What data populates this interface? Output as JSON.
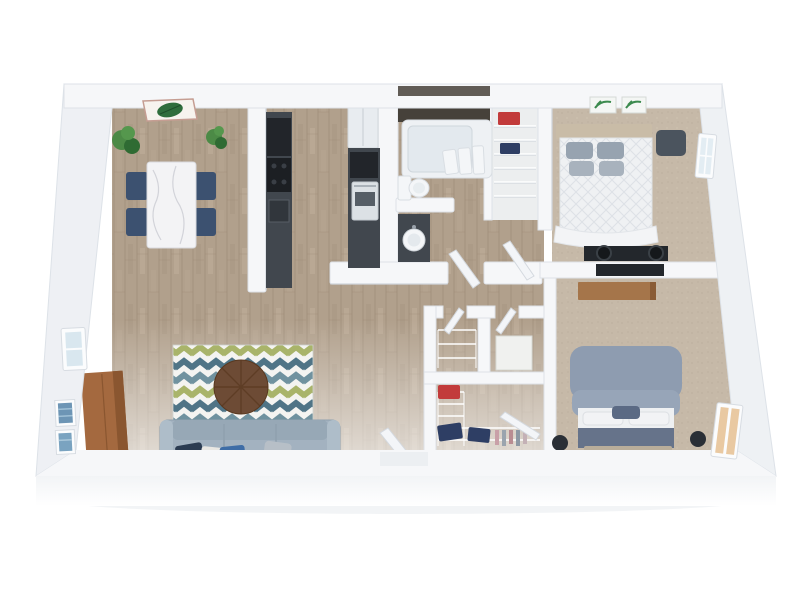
{
  "scene": {
    "type": "3d-rendered-floorplan",
    "camera": "top-down isometric, two-bedroom apartment",
    "rooms": [
      {
        "name": "dining-area",
        "floor": "wood",
        "furniture": [
          "marble-dining-table",
          "navy-dining-chair x4",
          "potted-plant x2",
          "leaf-wall-art"
        ]
      },
      {
        "name": "kitchen",
        "floor": "wood",
        "furniture": [
          "dark-counter-left",
          "dishwasher",
          "range",
          "sink",
          "refrigerator",
          "oven",
          "dark-counter-right"
        ]
      },
      {
        "name": "bathroom",
        "floor": "wood",
        "furniture": [
          "dark-accent-wall",
          "bathtub",
          "towels x3",
          "toilet",
          "vanity-counter",
          "round-sink"
        ]
      },
      {
        "name": "linen-closet",
        "floor": "light",
        "furniture": [
          "wire-shelving",
          "red-bin",
          "navy-bin"
        ]
      },
      {
        "name": "bedroom-1",
        "floor": "carpet",
        "furniture": [
          "tan-headboard",
          "white-quilted-bed",
          "gray-pillows x4",
          "green-wall-art x2",
          "dark-bench",
          "desk",
          "round-stool x2",
          "window"
        ]
      },
      {
        "name": "bedroom-2",
        "floor": "carpet",
        "furniture": [
          "gray-blue-upholstered-bed",
          "white-sheets",
          "pillows",
          "dark-blanket",
          "foot-bench",
          "speaker x2",
          "wall-tv",
          "floating-wood-shelf",
          "lit-window"
        ]
      },
      {
        "name": "living-room",
        "floor": "wood",
        "furniture": [
          "chevron-rug",
          "round-wood-coffee-table",
          "gray-blue-sofa",
          "throw-pillow x4",
          "wood-media-cabinet",
          "blue-wall-art x2",
          "window"
        ]
      },
      {
        "name": "hall-closets",
        "floor": "wood",
        "furniture": [
          "wire-shelf-closet",
          "white-storage-box",
          "tall-wire-unit",
          "red-basket",
          "navy-basket x2",
          "hanging-clothes"
        ]
      }
    ],
    "doors": [
      "entry-door-ajar",
      "bathroom-door-ajar",
      "bedroom-1-door-ajar",
      "bedroom-2-door-ajar",
      "closet-door-ajar x2"
    ],
    "windows": [
      "living-room-left-wall",
      "bedroom-1-right-wall",
      "bedroom-2-right-wall-lit"
    ]
  },
  "palette": {
    "background": "#ffffff",
    "wall_top": "#f6f7f9",
    "wall_face": "#eef0f4",
    "wall_edge": "#dde2e8",
    "wood_floor": "#b1a08c",
    "wood_line": "#9d8b77",
    "carpet": "#c6b9a8",
    "closet_floor": "#eceeef",
    "accent_wall": "#46413a",
    "counter_dark": "#41474e",
    "appliance_black": "#22252a",
    "fridge_white": "#e8ecf0",
    "oven_white": "#dce1e5",
    "marble": "#f3f3f5",
    "chair_navy": "#3c5170",
    "sofa": "#a3b2c0",
    "pillow_navy": "#2c3c52",
    "pillow_blue": "#3f6da6",
    "pillow_white": "#e9e7e3",
    "pillow_gray": "#b7bfc7",
    "rug_white": "#f4f4f1",
    "rug_blue": "#70929f",
    "rug_olive": "#a9b46a",
    "rug_teal": "#4f7486",
    "table_brown": "#6d4b35",
    "cabinet_wood": "#a4693f",
    "shelf_wood": "#a5754a",
    "bed1_quilt": "#eff1f3",
    "bed1_headboard": "#c9bca7",
    "bed1_pillow": "#97a3b0",
    "bench_dark": "#4b545e",
    "bed2_upholstery": "#8e9cb0",
    "blanket_dark": "#66738a",
    "sheet_white": "#eef0f2",
    "speaker_dark": "#2a2f36",
    "tv_dark": "#23272c",
    "tub_white": "#eef1f4",
    "fixture_white": "#f4f6f8",
    "glass_cool": "#d9e7ef",
    "glass_warm": "#e9c9a2",
    "basket_red": "#c23b3b",
    "basket_navy": "#2e3e64",
    "plant_green": "#4c8a46",
    "plant_green_dark": "#2f6b33",
    "art_leaf_green": "#2f6d3c",
    "art_blue": "#6d95b5",
    "wire_shelf": "#ffffff"
  }
}
